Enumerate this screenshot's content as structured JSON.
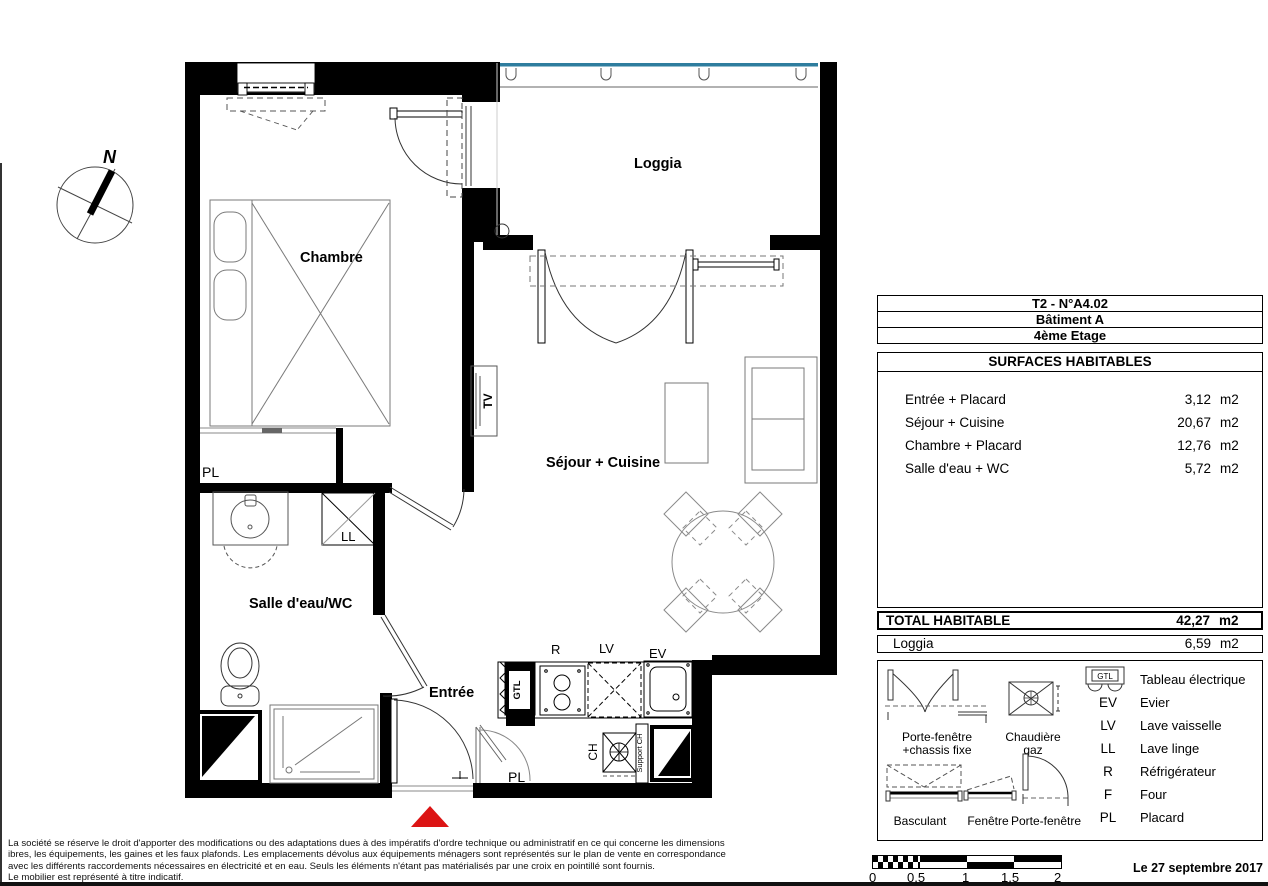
{
  "plan": {
    "compass": "N",
    "labels": {
      "chambre": "Chambre",
      "loggia": "Loggia",
      "sejour": "Séjour + Cuisine",
      "salle_eau": "Salle d'eau/WC",
      "entree": "Entrée",
      "pl_chambre": "PL",
      "pl_entree": "PL",
      "ll": "LL",
      "tv": "TV",
      "gtl": "GTL",
      "r": "R",
      "lv": "LV",
      "ev": "EV",
      "ch": "CH",
      "support_ch": "Support CH"
    }
  },
  "info_panel": {
    "unit_title": "T2 - N°A4.02",
    "building": "Bâtiment A",
    "floor": "4ème Etage",
    "surfaces_title": "SURFACES HABITABLES",
    "surfaces": [
      {
        "label": "Entrée + Placard",
        "value": "3,12",
        "unit": "m2"
      },
      {
        "label": "Séjour + Cuisine",
        "value": "20,67",
        "unit": "m2"
      },
      {
        "label": "Chambre + Placard",
        "value": "12,76",
        "unit": "m2"
      },
      {
        "label": "Salle d'eau + WC",
        "value": "5,72",
        "unit": "m2"
      }
    ],
    "total_label": "TOTAL HABITABLE",
    "total_value": "42,27",
    "total_unit": "m2",
    "loggia_label": "Loggia",
    "loggia_value": "6,59",
    "loggia_unit": "m2"
  },
  "legend": {
    "electrical": {
      "symbol_text": "GTL",
      "label": "Tableau électrique"
    },
    "items": [
      {
        "code": "EV",
        "label": "Evier"
      },
      {
        "code": "LV",
        "label": "Lave vaisselle"
      },
      {
        "code": "LL",
        "label": "Lave linge"
      },
      {
        "code": "R",
        "label": "Réfrigérateur"
      },
      {
        "code": "F",
        "label": "Four"
      },
      {
        "code": "PL",
        "label": "Placard"
      }
    ],
    "sym_portefenetre_line1": "Porte-fenêtre",
    "sym_portefenetre_line2": "+chassis fixe",
    "sym_chaudiere_line1": "Chaudière",
    "sym_chaudiere_line2": "gaz",
    "sym_basculant": "Basculant",
    "sym_fenetre": "Fenêtre",
    "sym_portefenetre2": "Porte-fenêtre"
  },
  "scale_bar": {
    "ticks": [
      "0",
      "0,5",
      "1",
      "1,5",
      "2"
    ]
  },
  "footer": {
    "disclaimer_lines": [
      "La société se réserve le droit d'apporter des modifications ou des adaptations dues à des impératifs d'ordre technique ou administratif en ce qui concerne les dimensions",
      "ibres, les équipements, les gaines et les faux plafonds. Les emplacements dévolus aux équipements ménagers sont représentés sur le plan de vente en correspondance",
      "avec les différents raccordements nécessaires en électricité et en eau. Seuls les éléments n'étant pas matérialisés par une croix en pointillé sont fournis.",
      "Le mobilier est représenté à titre indicatif."
    ],
    "date": "Le 27 septembre 2017"
  },
  "colors": {
    "railing_blue": "#2e7d9e",
    "entry_red": "#dc1414"
  }
}
